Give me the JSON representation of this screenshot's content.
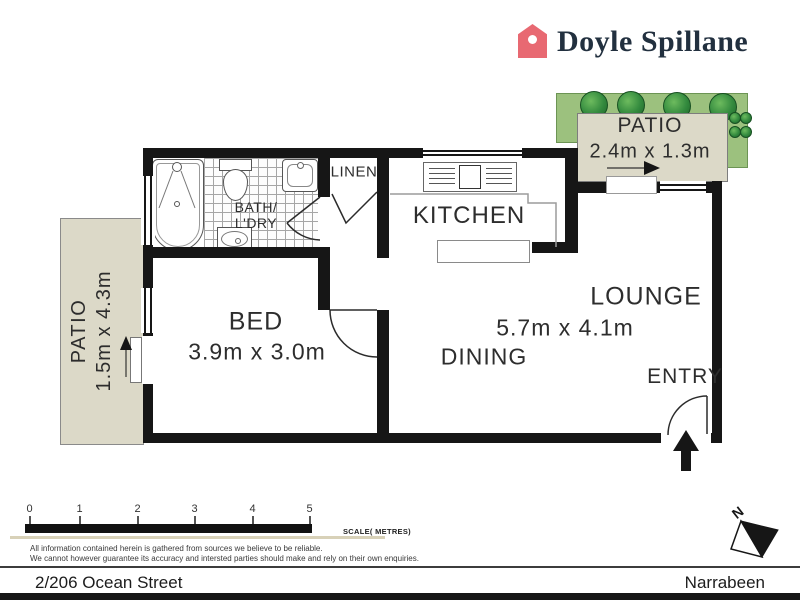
{
  "brand": {
    "name": "Doyle Spillane",
    "logo_icon": "house-icon",
    "logo_color": "#e86972",
    "name_color": "#22303f"
  },
  "plan": {
    "rooms": {
      "patio_left": {
        "name": "PATIO",
        "dims": "1.5m x 4.3m"
      },
      "patio_top": {
        "name": "PATIO",
        "dims": "2.4m x 1.3m"
      },
      "bed": {
        "name": "BED",
        "dims": "3.9m x 3.0m"
      },
      "bath": {
        "name_line1": "BATH/",
        "name_line2": "L'DRY"
      },
      "linen": {
        "name": "LINEN"
      },
      "kitchen": {
        "name": "KITCHEN"
      },
      "lounge": {
        "name": "LOUNGE",
        "dims": "5.7m x 4.1m"
      },
      "dining": {
        "name": "DINING"
      },
      "entry": {
        "name": "ENTRY"
      }
    },
    "fixtures": [
      "bathtub-icon",
      "shower-icon",
      "toilet-icon",
      "basin-icon",
      "laundry-tub-icon",
      "cooktop-icon",
      "island-bench-icon",
      "bush-icon",
      "plant-icon"
    ]
  },
  "scale_bar": {
    "ticks": [
      "0",
      "1",
      "2",
      "3",
      "4",
      "5"
    ],
    "label": "SCALE( METRES)"
  },
  "compass": {
    "label": "N"
  },
  "disclaimer": {
    "line1": "All information contained herein is gathered from sources we believe to be reliable.",
    "line2": "We cannot however guarantee its accuracy and intersted parties should make and rely on their own enquiries."
  },
  "footer": {
    "address": "2/206 Ocean Street",
    "suburb": "Narrabeen"
  },
  "colors": {
    "wall": "#161616",
    "patio_fill": "#dcd9c8",
    "garden_green": "#9cc17e",
    "scale_tan": "#d8d1b8"
  }
}
